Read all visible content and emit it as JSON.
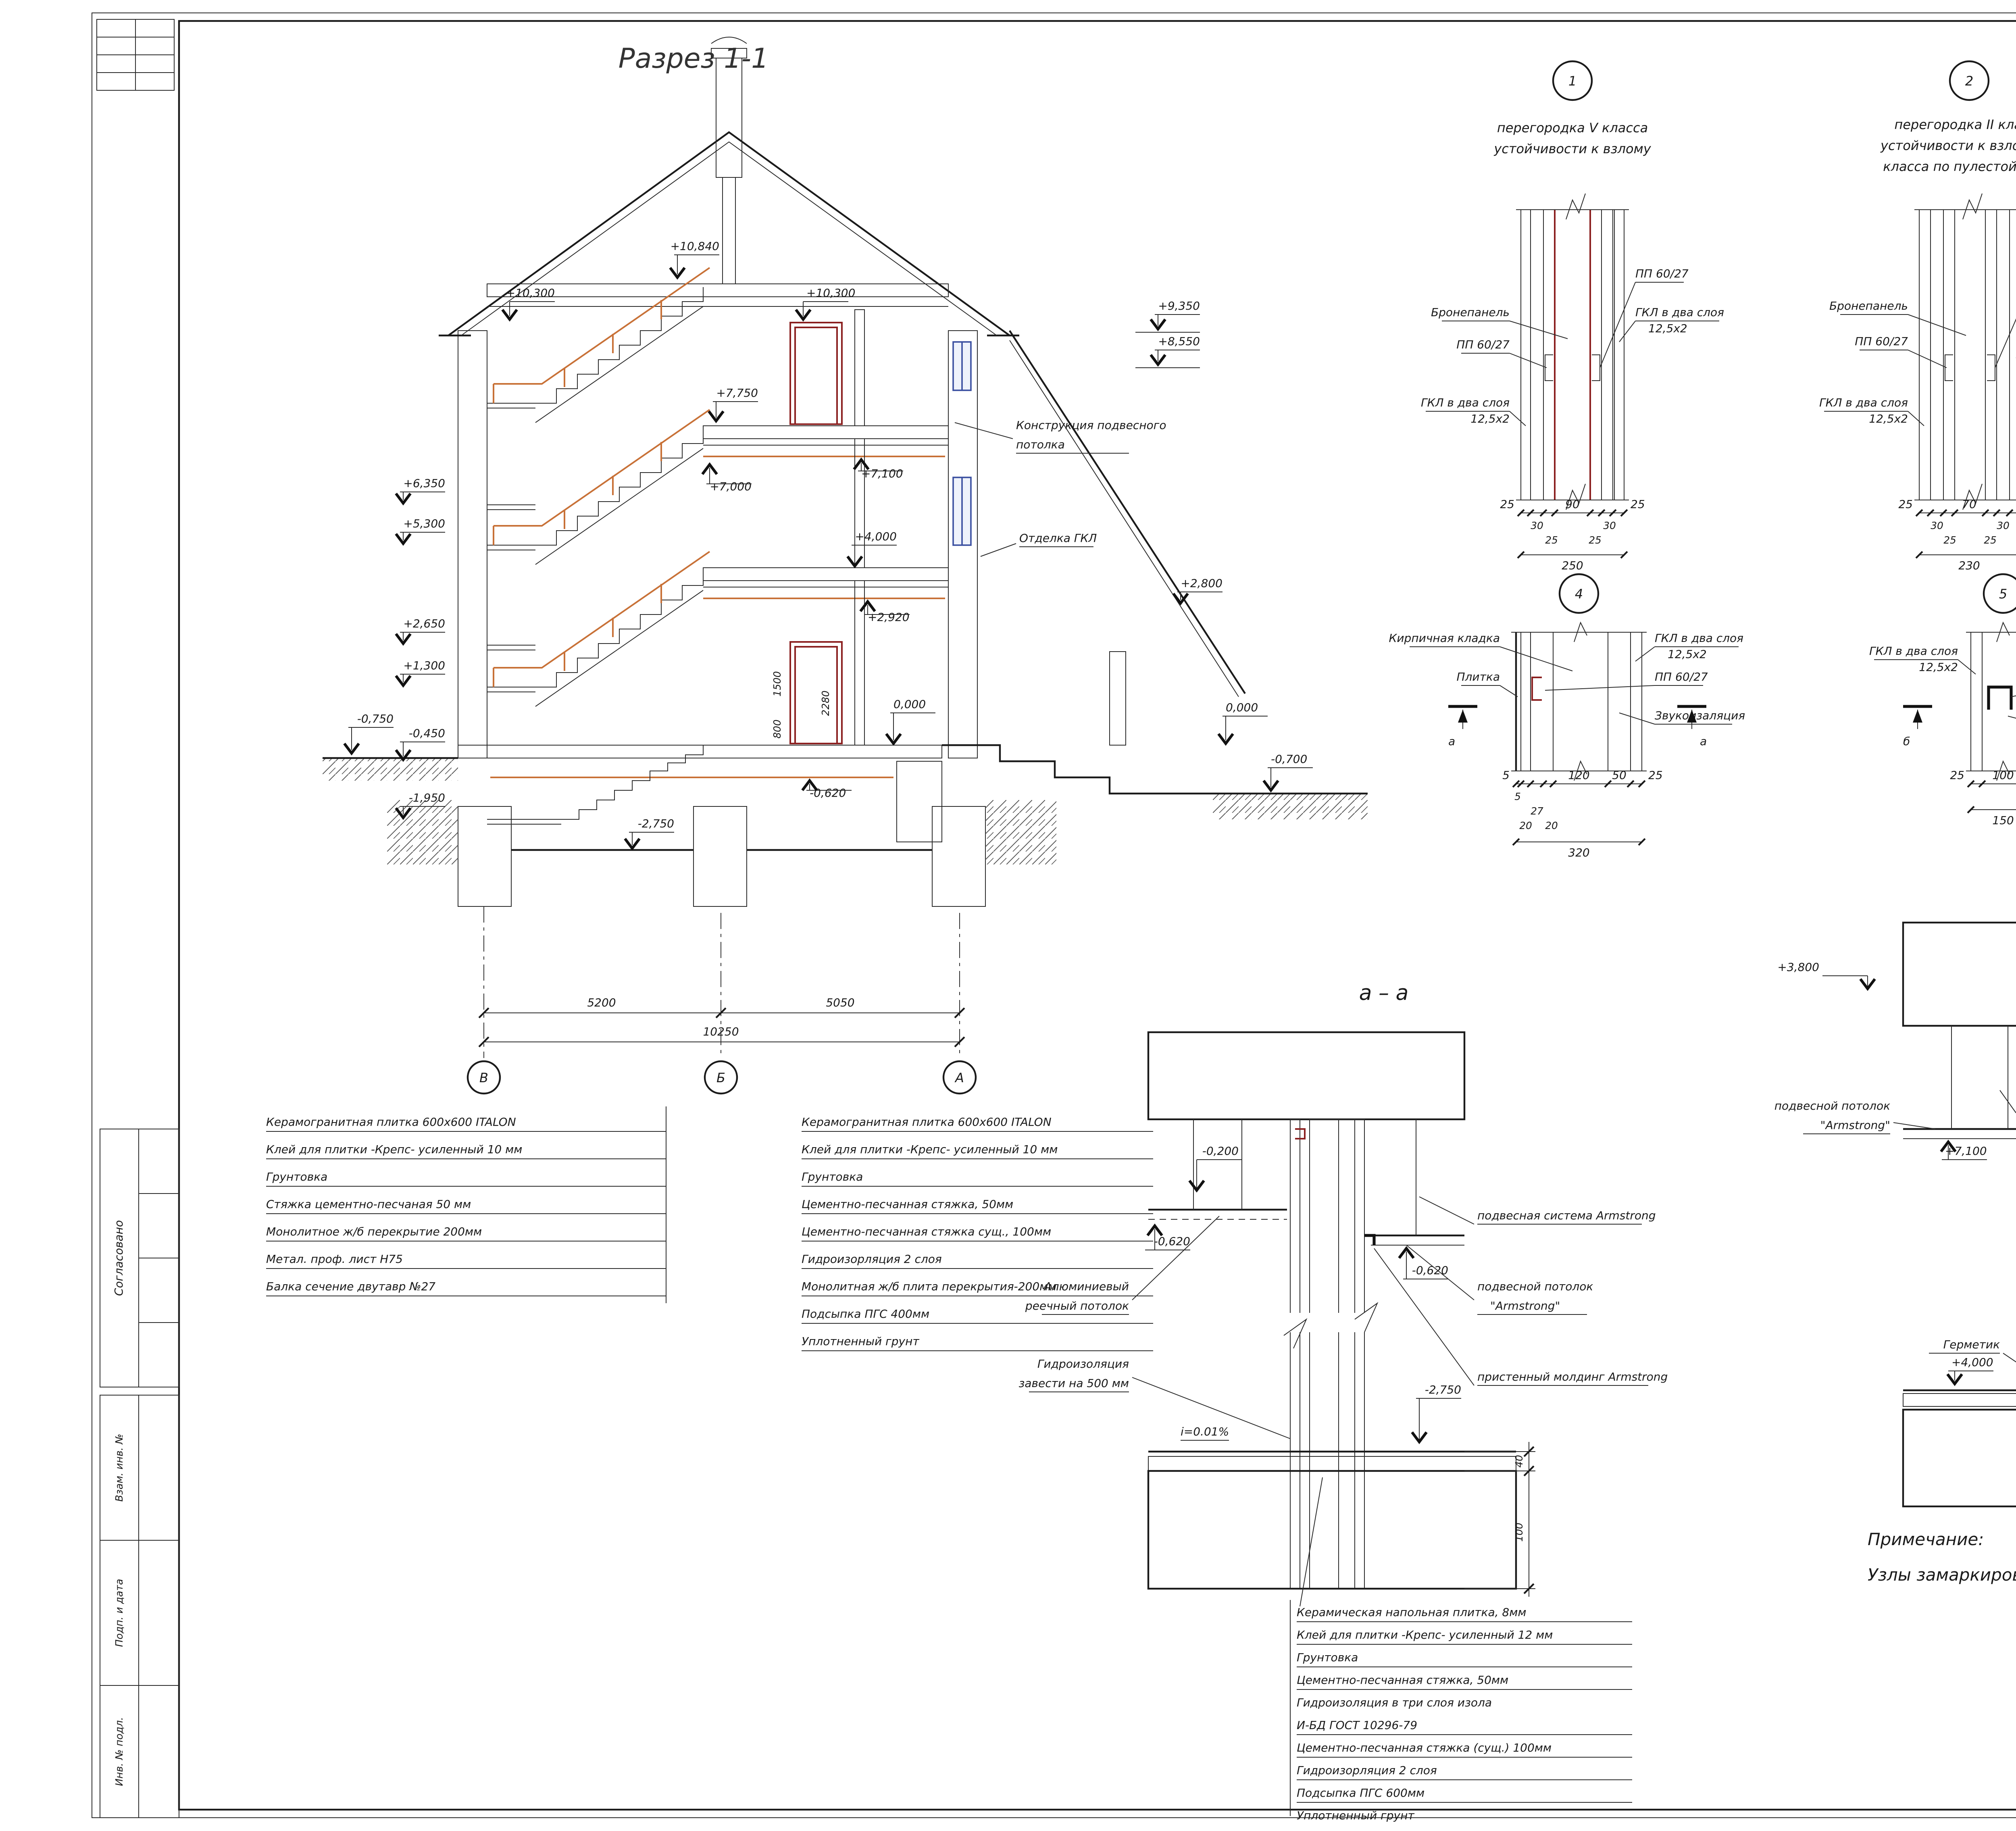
{
  "sheet": {
    "title": "Разрез 1-1",
    "note_title": "Примечание:",
    "note_body": "Узлы замаркированы на листах 15, 16 и 17"
  },
  "margin": {
    "agreed": "Согласовано",
    "box1": "Взам. инв. №",
    "box2": "Подп. и дата",
    "box3": "Инв. № подл."
  },
  "bld": {
    "elev": {
      "e10840": "+10,840",
      "e10300l": "+10,300",
      "e10300r": "+10,300",
      "e7750": "+7,750",
      "e7000": "+7,000",
      "e7100": "+7,100",
      "e6350": "+6,350",
      "e5300": "+5,300",
      "e4000": "+4,000",
      "e2920": "+2,920",
      "e2650": "+2,650",
      "e1300": "+1,300",
      "em045": "-0,450",
      "em195": "-1,950",
      "em075": "-0,750",
      "e0i": "0,000",
      "em062": "-0,620",
      "em275": "-2,750",
      "e9350": "+9,350",
      "e8550": "+8,550",
      "e2800": "+2,800",
      "e0r": "0,000",
      "em070": "-0,700"
    },
    "vdim": {
      "d2280": "2280",
      "d1500": "1500",
      "d800": "800"
    },
    "lbl_ceiling1": "Конструкция подвесного",
    "lbl_ceiling2": "потолка",
    "lbl_gkl": "Отделка ГКЛ",
    "dim5200": "5200",
    "dim5050": "5050",
    "dim10250": "10250",
    "axV": "В",
    "axB": "Б",
    "axA": "А"
  },
  "d1": {
    "num": "1",
    "t1": "перегородка V класса",
    "t2": "устойчивости к взлому",
    "armor": "Бронепанель",
    "pp_l": "ПП 60/27",
    "pp_r": "ПП 60/27",
    "gkl_l1": "ГКЛ в два слоя",
    "gkl_l2": "12,5х2",
    "gkl_r1": "ГКЛ в два слоя",
    "gkl_r2": "12,5х2",
    "dims": {
      "a": "25",
      "b": "30",
      "c": "25",
      "core": "90",
      "e": "25",
      "f": "30",
      "g": "25",
      "total": "250"
    }
  },
  "d2": {
    "num": "2",
    "t1": "перегородка II класса",
    "t2": "устойчивости к взлому и I",
    "t3": "класса по пулестойкости",
    "armor": "Бронепанель",
    "pp_l": "ПП 60/27",
    "pp_r": "ПП 60/27",
    "gkl_l1": "ГКЛ в два слоя",
    "gkl_l2": "12,5х2",
    "gkl_r1": "ГКЛ в два слоя",
    "gkl_r2": "12,5х2",
    "dims": {
      "a": "25",
      "b": "30",
      "c": "25",
      "core": "70",
      "e": "25",
      "f": "30",
      "g": "25",
      "total": "230"
    }
  },
  "d3": {
    "num": "3",
    "t1": "перегородка II класса",
    "t2": "устойчивости к взлому и III",
    "t3": "класса по пулестойкости",
    "armor": "Бронепанель",
    "pp_l": "ПП 60/27",
    "pp_r": "ПП 60/27",
    "gkl_l1": "ГКЛ в два слоя",
    "gkl_l2": "12,5х2",
    "gkl_r1": "ГКЛ в два слоя",
    "gkl_r2": "12,5х2",
    "dims": {
      "a": "25",
      "b": "30",
      "c": "25",
      "core": "70",
      "e": "25",
      "f": "30",
      "g": "25",
      "total": "230"
    }
  },
  "d4": {
    "num": "4",
    "brick": "Кирпичная кладка",
    "tile": "Плитка",
    "gkl1": "ГКЛ в два слоя",
    "gkl2": "12,5х2",
    "pp": "ПП 60/27",
    "snd": "Звукоизаляция",
    "mark": "а",
    "dims": {
      "a": "5",
      "b": "5",
      "c": "20",
      "d": "27",
      "e": "20",
      "f": "120",
      "g": "50",
      "h": "25",
      "total": "320"
    }
  },
  "d5": {
    "num": "5",
    "gkl_l1": "ГКЛ в два слоя",
    "gkl_l2": "12,5х2",
    "gkl_r1": "ГКЛ в два слоя",
    "gkl_r2": "12,5х2",
    "ps": "ПС 100/50",
    "snd": "Звукоизаляция",
    "mark": "б",
    "dims": {
      "a": "25",
      "b": "100",
      "c": "25",
      "total": "150"
    }
  },
  "d6": {
    "num": "6",
    "anchor1": "Анкер мет А-III ∅ 12 мм",
    "anchor2": "с шагом 500х500 мм",
    "mesh1": "Арматурная сетка А III ∅12мм",
    "mesh2": "100х100 мм",
    "pp": "ПП 60/27",
    "brick1": "Кирпичная кладка",
    "brick2": "t = 120 мм",
    "gkl_l1": "ГКЛ в два слоя",
    "gkl_l2": "12,5х2",
    "ps": "ПС 50",
    "gkl_r1": "ГКЛ в два слоя",
    "gkl_r2": "12,5х2",
    "snd": "Звукоизаляция",
    "dims": {
      "a": "25",
      "b": "27",
      "c": "10",
      "d": "120",
      "e": "20",
      "f": "50",
      "g": "25",
      "total": "280"
    }
  },
  "sa": {
    "title": "а – а",
    "em02": "-0,200",
    "em062l": "-0,620",
    "em062r": "-0,620",
    "em275": "-2,750",
    "slope": "i=0.01%",
    "sys": "подвесная система Armstrong",
    "ceil1": "подвесной потолок",
    "ceil2": "\"Armstrong\"",
    "mold": "пристенный молдинг Armstrong",
    "alu1": "Алюминиевый",
    "alu2": "реечный потолок",
    "hydro1": "Гидроизоляция",
    "hydro2": "завести на 500 мм",
    "d40": "40",
    "d100": "100"
  },
  "sb": {
    "title": "б – б",
    "e3800": "+3,800",
    "e7100": "+7,100",
    "e7000": "+7,000",
    "e4000": "+4,000",
    "pnp": "ПНП 28/27",
    "ceil1": "подвесной потолок",
    "ceil2": "\"Armstrong\"",
    "germ": "Герметик",
    "pn": "ПН 100/50"
  },
  "lists": {
    "b": [
      "Керамогранитная  плитка 600х600 ITALON",
      "Клей для плитки -Крепс- усиленный 10 мм",
      "Грунтовка",
      "Стяжка цементно-песчаная 50 мм",
      "Монолитное ж/б перекрытие 200мм",
      "Метал. проф. лист Н75",
      "Балка сечение двутавр №27"
    ],
    "a": [
      "Керамогранитная  плитка 600х600 ITALON",
      "Клей для плитки -Крепс- усиленный 10 мм",
      "Грунтовка",
      "Цементно-песчанная стяжка, 50мм",
      "Цементно-песчанная стяжка сущ., 100мм",
      "Гидроизорляция 2 слоя",
      "Монолитная ж/б плита  перекрытия-200мм",
      "Подсыпка ПГС 400мм",
      "Уплотненный грунт"
    ],
    "floor": [
      "Керамическая напольная плитка, 8мм",
      "Клей для плитки -Крепс- усиленный 12 мм",
      "Грунтовка",
      "Цементно-песчанная стяжка, 50мм",
      "Гидроизоляция в три слоя изола",
      "И-БД ГОСТ 10296-79",
      "Цементно-песчанная стяжка (сущ.) 100мм",
      "Гидроизорляция 2 слоя",
      "Подсыпка ПГС 600мм",
      "Уплотненный грунт"
    ],
    "right": [
      "Коммер. линолеум \"Tarkett Prima Plus\"",
      "Слой клея",
      "Цементно-песчанная стяжка, 50мм",
      "Монолитное ж/б перекрытие 200мм",
      "Проф. лист оцинкованный Н 75",
      "Балка двутавр №25"
    ]
  }
}
